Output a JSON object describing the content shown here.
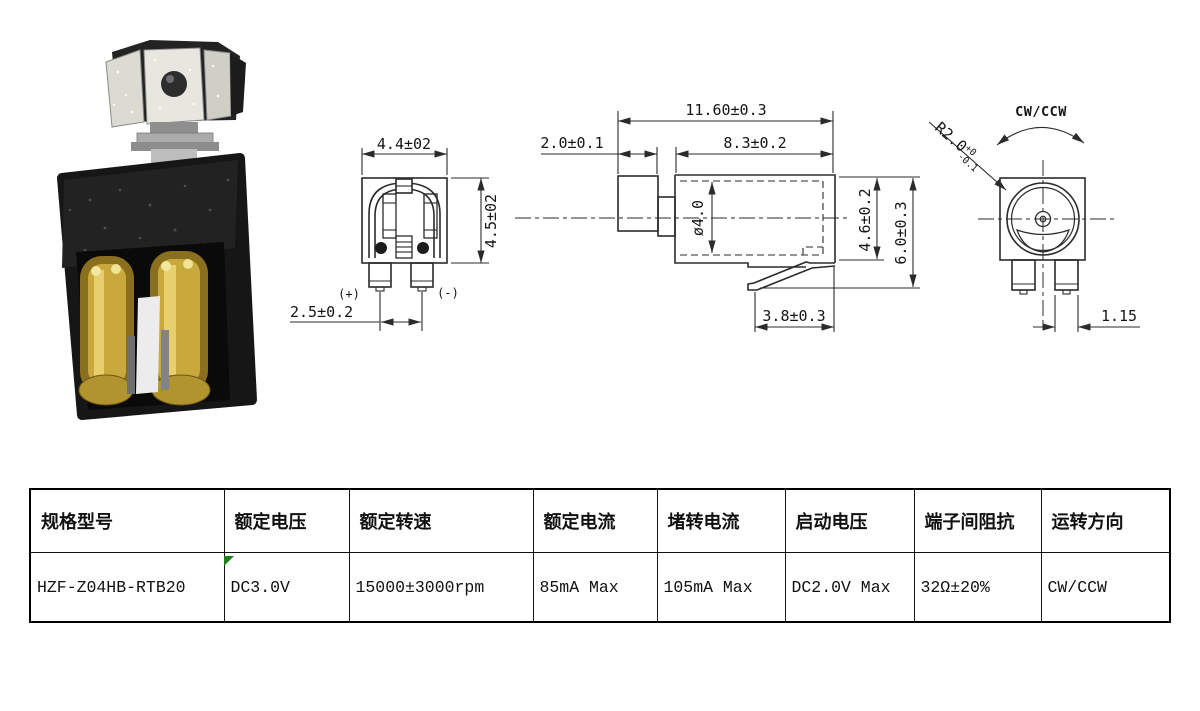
{
  "page": {
    "background": "#ffffff",
    "line_color": "#2b2b2b"
  },
  "photo": {
    "description": "coin vibration motor product photo"
  },
  "front_view": {
    "dim_width": "4.4±02",
    "dim_height": "4.5±02",
    "dim_pin_pitch": "2.5±0.2",
    "polarity_plus": "(+)",
    "polarity_minus": "(-)"
  },
  "side_view": {
    "dim_total_length": "11.60±0.3",
    "dim_weight_length": "2.0±0.1",
    "dim_body_length": "8.3±0.2",
    "dim_diameter": "ø4.0",
    "dim_body_height": "4.6±0.2",
    "dim_overall_height": "6.0±0.3",
    "dim_terminal": "3.8±0.3"
  },
  "end_view": {
    "rotation": "CW/CCW",
    "radius": "R2.0",
    "radius_tol_up": "+0",
    "radius_tol_down": "-0.1",
    "dim_pin_width": "1.15"
  },
  "spec_table": {
    "headers": [
      "规格型号",
      "额定电压",
      "额定转速",
      "额定电流",
      "堵转电流",
      "启动电压",
      "端子间阻抗",
      "运转方向"
    ],
    "row": [
      "HZF-Z04HB-RTB20",
      "DC3.0V",
      "15000±3000rpm",
      "85mA Max",
      "105mA Max",
      "DC2.0V Max",
      "32Ω±20%",
      "CW/CCW"
    ]
  }
}
